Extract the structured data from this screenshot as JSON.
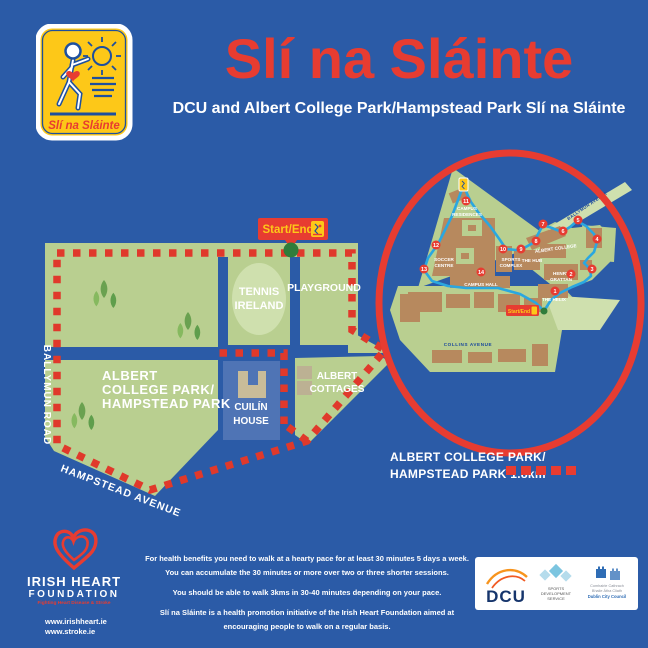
{
  "colors": {
    "background": "#2b5ba7",
    "brand_red": "#e73c31",
    "brand_yellow": "#fdc818",
    "park_green": "#b9cf90",
    "light_green": "#cfe0ae",
    "route_cyan": "#2aa7e0",
    "building_tan": "#b7895e",
    "start_dot_green": "#2f7d3b",
    "cuilin_blue": "#4f74b5"
  },
  "header": {
    "logo_text": "Slí na Sláinte",
    "title": "Slí na Sláinte",
    "subtitle": "DCU and Albert College Park/Hampstead Park Slí na Sláinte"
  },
  "map": {
    "start_end_label": "Start/End",
    "labels": {
      "tennis": [
        "TENNIS",
        "IRELAND"
      ],
      "playground": "PLAYGROUND",
      "park": [
        "ALBERT",
        "COLLEGE PARK/",
        "HAMPSTEAD PARK"
      ],
      "cuilin": [
        "CUILÍN",
        "HOUSE"
      ],
      "cottages": [
        "ALBERT",
        "COTTAGES"
      ]
    },
    "roads": {
      "ballymun": "BALLYMUN ROAD",
      "hampstead": "HAMPSTEAD AVENUE"
    }
  },
  "inset": {
    "start_end_label": "Start/End",
    "buildings": {
      "campus_residences": [
        "CAMPUS",
        "RESIDENCES"
      ],
      "soccer_centre": [
        "SOCCER",
        "CENTRE"
      ],
      "sports_complex": [
        "SPORTS",
        "COMPLEX"
      ],
      "the_hub": "THE HUB",
      "campus_hall": "CAMPUS HALL",
      "albert_college": "ALBERT COLLEGE",
      "henry_grattan": [
        "HENRY",
        "GRATTAN"
      ],
      "the_helix": "THE HELIX"
    },
    "roads": {
      "collins": "COLLINS AVENUE",
      "ballymun_avenue": "BALLYMUN AVENUE"
    },
    "waypoints": [
      "1",
      "2",
      "3",
      "4",
      "5",
      "6",
      "7",
      "8",
      "9",
      "10",
      "11",
      "12",
      "13",
      "14"
    ]
  },
  "legend": {
    "line1": "ALBERT COLLEGE PARK/",
    "line2": "HAMPSTEAD PARK 1.8km"
  },
  "footer": {
    "ihf": {
      "name1": "IRISH HEART",
      "name2": "FOUNDATION",
      "tagline": "Fighting Heart Disease & Stroke",
      "url1": "www.irishheart.ie",
      "url2": "www.stroke.ie"
    },
    "paragraphs": {
      "p1a": "For health benefits you need to walk at a hearty pace for at least 30 minutes 5 days a week.",
      "p1b": "You can accumulate the 30 minutes or more over two or three shorter sessions.",
      "p2": "You should be able to walk 3kms in 30-40 minutes depending on your pace.",
      "p3a": "Slí na Sláinte is a health promotion initiative of the Irish Heart Foundation aimed at",
      "p3b": "encouraging people to walk on a regular basis."
    },
    "logos": {
      "dcu": "DCU",
      "sds": [
        "SPORTS",
        "DEVELOPMENT",
        "SERVICE"
      ],
      "dcc": [
        "Comhairle Cathrach",
        "Bhaile Átha Cliath",
        "Dublin City Council"
      ]
    }
  }
}
